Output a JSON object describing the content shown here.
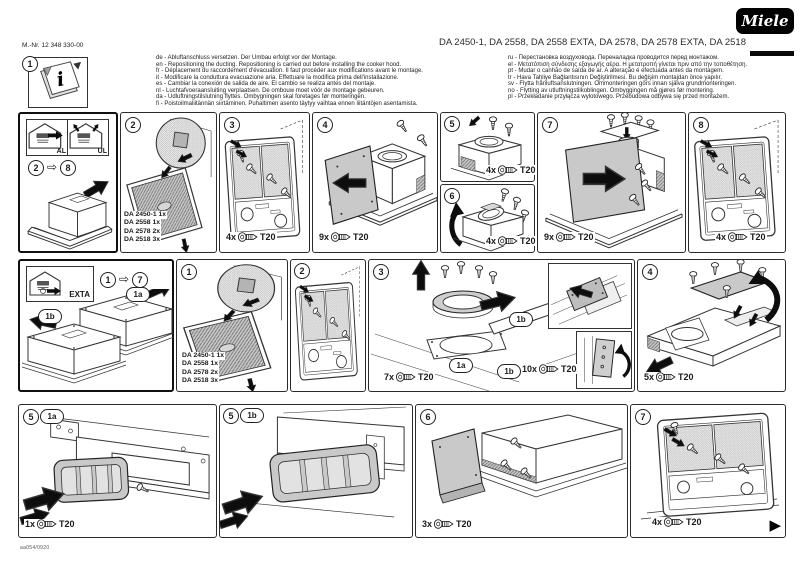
{
  "brand": {
    "logo_text": "Miele"
  },
  "doc": {
    "m_nr": "M.-Nr. 12 348 330-00",
    "title": "DA 2450-1, DA 2558, DA 2558 EXTA, DA 2578, DA 2578 EXTA, DA 2518",
    "footer_code": "aa054/0920"
  },
  "icons": {
    "range_arrow": "⇨",
    "continue_triangle": "▶",
    "booklet_i": "i",
    "screw": "torx-screw",
    "booklet": "instruction-booklet"
  },
  "intro": {
    "step": "1"
  },
  "instructions": {
    "left": [
      "de - Abluftanschluss versetzen. Der Umbau erfolgt vor der Montage.",
      "en - Repositioning the ducting. Repositioning is carried out before installing the cooker hood.",
      "fr - Déplacement du raccordement d'évacuation. Il faut procéder aux modifications avant le montage.",
      "it - Modificare la conduttura evacuazione aria. Effettuare la modifica prima dell'installazione.",
      "es - Cambiar la conexión de salida de aire. El cambio se realiza antes del montaje.",
      "nl - Luchtafvoeraansluiting verplaatsen. De ombouw moet vóór de montage gebeuren.",
      "da - Udluftningstilslutning flyttes. Ombygningen skal foretages før monteringen.",
      "fi - Poistoilmaliitännän siirtäminen. Puhaltimen asento täytyy vaihtaa ennen liitäntöjen asentamista."
    ],
    "right": [
      "ru - Перестановка воздуховода. Переналадка проводится перед монтажом.",
      "el - Μετατόπιση σύνδεσης εξαγωγής αέρα. Η μετατροπή γίνεται πριν από την τοποθέτηση.",
      "pt - Mudar o canhão de saída de ar. A alteração é efectuada antes da montagem.",
      "tr - Hava Tahliye Bağlantısının Değiştirilmesi. Bu değişim montajdan önce yapılır.",
      "sv - Flytta frånluftsanslutningen. Ommonteringen görs innan själva grundmonteringen.",
      "no - Flytting av utluftningstilkoblingen. Ombyggingen må gjøres før montering.",
      "pl - Przekładanie przyłącza wylotowego. Przebudowa odbywa się przed montażem."
    ]
  },
  "filter_counts": [
    "DA 2450-1 1x",
    "DA 2558 1x",
    "DA 2578 2x",
    "DA 2518 3x"
  ],
  "tool": "T20",
  "overview_row1": {
    "mode_left": "AL",
    "mode_right": "UL",
    "step_from": "2",
    "step_to": "8"
  },
  "overview_row2": {
    "mode": "EXTA",
    "step_from": "1",
    "step_to": "7",
    "variant_a": "1a",
    "variant_b": "1b"
  },
  "steps": {
    "r1s2": {
      "num": "2"
    },
    "r1s3": {
      "num": "3",
      "screws": "4x"
    },
    "r1s4": {
      "num": "4",
      "screws": "9x"
    },
    "r1s5": {
      "num": "5",
      "screws": "4x"
    },
    "r1s6": {
      "num": "6",
      "screws": "4x"
    },
    "r1s7": {
      "num": "7",
      "screws": "9x"
    },
    "r1s8": {
      "num": "8",
      "screws": "4x"
    },
    "r2s1": {
      "num": "1"
    },
    "r2s2": {
      "num": "2"
    },
    "r2s3": {
      "num": "3",
      "variant_a": "1a",
      "screws_a": "7x",
      "variant_b": "1b",
      "screws_b": "10x"
    },
    "r2s4": {
      "num": "4",
      "screws": "5x"
    },
    "r3s5a": {
      "num": "5",
      "variant": "1a",
      "screws": "1x"
    },
    "r3s5b": {
      "num": "5",
      "variant": "1b"
    },
    "r3s6": {
      "num": "6",
      "screws": "3x"
    },
    "r3s7": {
      "num": "7",
      "screws": "4x"
    }
  }
}
